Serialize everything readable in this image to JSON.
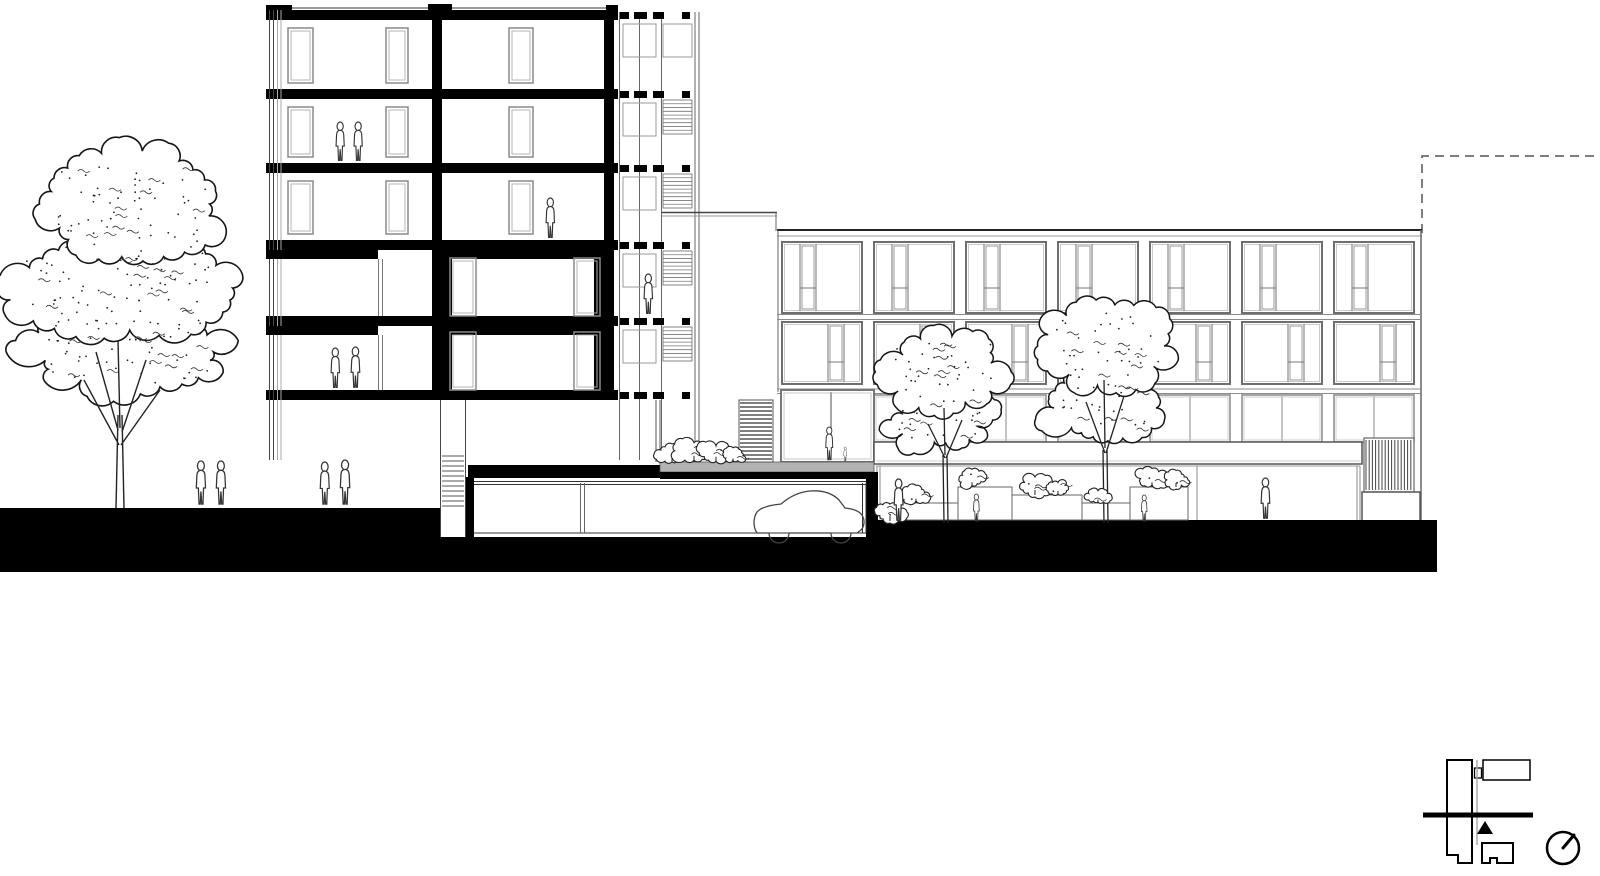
{
  "scene": {
    "kind": "architectural-section-elevation-drawing",
    "width": 1600,
    "height": 876,
    "background": "#ffffff",
    "description": "Black-and-white building cross-section / street elevation: five-storey sectioned tower with stair annex at left, four-storey apartment block elevation at right, underground parking garage with car, courtyard with trees, planters and human figures, large tree at far left, site key plan with section line and north arrow at bottom right"
  },
  "palette": {
    "ink": "#111111",
    "wall_black": "#000000",
    "line_dark": "#333333",
    "line_mid": "#777777",
    "line_light": "#b5b5b5",
    "terrace_gray": "#b3b3b3",
    "paper": "#ffffff"
  },
  "tower": {
    "x": 266,
    "right": 618,
    "storeys": 5,
    "slab_ys": [
      10,
      89,
      163,
      240,
      316,
      390
    ],
    "slab_h": 10,
    "roof_line_y": 8,
    "roof_upstands": [
      [
        266,
        5,
        26,
        5
      ],
      [
        428,
        4,
        24,
        6
      ],
      [
        606,
        5,
        12,
        5
      ]
    ],
    "center_wall_x": 432,
    "right_wall_x": 604,
    "wall_w": 10,
    "left_rail_xs": [
      269.5,
      273.5,
      277.5,
      281
    ],
    "heavy_floors": [
      3,
      4
    ],
    "heavy_lintel_left_w": 112,
    "heavy_window_xs": [
      378.5,
      382.5
    ],
    "doors_upper_left": [
      [
        288,
        25
      ],
      [
        386,
        22
      ]
    ],
    "door_upper_right": [
      509,
      24
    ],
    "doors_heavy_right": [
      [
        450,
        26
      ],
      [
        574,
        26
      ]
    ]
  },
  "annex": {
    "x": 618,
    "right": 700,
    "col_xs": [
      619.5,
      639.5,
      661.5,
      695,
      699
    ],
    "col_y1": 12,
    "col_y2": 460,
    "dash_segs": [
      [
        620,
        9
      ],
      [
        634,
        13
      ],
      [
        653,
        11
      ],
      [
        682,
        8
      ]
    ],
    "dash_h": 7,
    "rail": {
      "x": 623,
      "w": 33,
      "h": 33
    },
    "hatch": {
      "x": 663,
      "w": 29,
      "h": 34,
      "lines": 8
    },
    "low_wing": {
      "x1": 662,
      "x2": 777,
      "y1": 212.5,
      "y2": 216,
      "drop_x": 776,
      "drop_y": 231
    }
  },
  "right_building": {
    "x": 777,
    "right": 1422,
    "parapet_y": 230,
    "parapet_y2": 236,
    "band_lines": [
      314.5,
      319.5,
      389,
      393.5
    ],
    "bays": 7,
    "bay_start": 782,
    "bay_pitch": 92,
    "bay_w": 80,
    "rowA": {
      "y": 242,
      "h": 71,
      "door_off": 18,
      "door_w": 16,
      "rail_dy": 46
    },
    "rowB": {
      "y": 322,
      "h": 62,
      "door_off": 46,
      "door_w": 16,
      "rail_dy": 40
    },
    "glass_band": {
      "y": 395,
      "h": 47,
      "first_bay": 1
    },
    "tall_bay": {
      "x": 781,
      "y": 390,
      "w": 93,
      "h": 72,
      "mullion_x": 831
    },
    "canopy": {
      "x": 874,
      "y": 442,
      "w": 488,
      "h": 22
    },
    "storefront_cols": [
      877,
      880,
      1197,
      1357,
      1360
    ],
    "storefront_y1": 466,
    "storefront_y2": 520,
    "louver": {
      "x": 1364,
      "y": 438,
      "w": 50,
      "h": 54,
      "step": 3.2
    },
    "louver_base": {
      "x": 1362,
      "y": 492,
      "w": 58,
      "h": 31
    }
  },
  "terrace": {
    "black_slab": [
      468,
      465,
      194,
      13
    ],
    "gray": [
      660,
      462,
      214,
      10
    ],
    "black_under": [
      660,
      472,
      217,
      7
    ],
    "vent": {
      "x": 739,
      "y": 400,
      "w": 34,
      "h": 62,
      "step": 4
    },
    "wall_xs": [
      656,
      660
    ],
    "wall_y1": 400,
    "wall_y2": 462
  },
  "garage": {
    "cavity": [
      474,
      480,
      392,
      53
    ],
    "ceil_ys": [
      481.5,
      484.5
    ],
    "floor_y": 533,
    "right_wall_xs": [
      862.5,
      866
    ],
    "column_xs": [
      580.5,
      584.5
    ],
    "shaft_x1": 440.5,
    "shaft_x2": 465.5,
    "shaft_top": 400,
    "shaft_bottom": 537,
    "rungs": {
      "y1": 456,
      "y2": 506,
      "step": 5
    }
  },
  "ground": {
    "color": "#000000",
    "rects": [
      [
        0,
        508,
        440,
        64
      ],
      [
        440,
        537,
        438,
        35
      ],
      [
        466,
        477,
        8,
        60
      ],
      [
        866,
        472,
        12,
        71
      ],
      [
        878,
        520,
        559,
        52
      ]
    ]
  },
  "boundary": {
    "path": "M1422,233 L1422,156 L1600,156",
    "dash": "9 6"
  },
  "planters": [
    [
      900,
      503,
      58,
      17
    ],
    [
      958,
      487,
      54,
      33
    ],
    [
      1012,
      495,
      70,
      25
    ],
    [
      1082,
      503,
      48,
      17
    ],
    [
      1130,
      487,
      58,
      33
    ]
  ],
  "figures": [
    [
      194,
      461,
      46
    ],
    [
      214,
      461,
      46
    ],
    [
      318,
      462,
      45
    ],
    [
      338,
      460,
      47
    ],
    [
      334,
      122,
      41
    ],
    [
      352,
      122,
      41
    ],
    [
      544,
      198,
      42
    ],
    [
      642,
      274,
      42
    ],
    [
      329,
      348,
      42
    ],
    [
      349,
      347,
      43
    ],
    [
      824,
      427,
      35
    ],
    [
      843,
      447,
      15
    ],
    [
      892,
      479,
      44
    ],
    [
      972,
      494,
      29
    ],
    [
      1140,
      495,
      28
    ],
    [
      1259,
      478,
      43
    ]
  ],
  "shrubs": [
    [
      672,
      462,
      0.9,
      21
    ],
    [
      694,
      462,
      1.25,
      22
    ],
    [
      716,
      462,
      1.05,
      23
    ],
    [
      733,
      462,
      0.7,
      24
    ],
    [
      890,
      521,
      1.0,
      25
    ],
    [
      916,
      503,
      0.85,
      26
    ],
    [
      972,
      487,
      0.95,
      27
    ],
    [
      1035,
      495,
      1.0,
      28
    ],
    [
      1058,
      495,
      0.8,
      29
    ],
    [
      1098,
      503,
      0.7,
      30
    ],
    [
      1152,
      487,
      0.95,
      31
    ],
    [
      1176,
      487,
      0.8,
      32
    ]
  ],
  "trees": {
    "large": {
      "lobes": [
        [
          128,
          352,
          102,
          42,
          0.2,
          23
        ],
        [
          118,
          288,
          114,
          50,
          0.18,
          11
        ],
        [
          132,
          204,
          92,
          58,
          0.16,
          7
        ]
      ],
      "trunk": "M116,508 L118,415 M124,508 L122,415 M118,430 L96,352 M122,432 L146,360 M120,428 L118,340 M119,445 L84,380 M121,445 L160,390"
    },
    "court_a": {
      "lobes": [
        [
          940,
          420,
          52,
          30,
          0.25,
          6
        ],
        [
          944,
          372,
          62,
          40,
          0.22,
          5
        ]
      ],
      "trunk": "M944,523 L943,455 M948,523 L947,455 M945,458 L928,424 M946,458 L962,420 M945,455 L944,408"
    },
    "court_b": {
      "lobes": [
        [
          1100,
          408,
          56,
          34,
          0.24,
          10
        ],
        [
          1106,
          346,
          66,
          44,
          0.2,
          9
        ]
      ],
      "trunk": "M1104,523 L1103,450 M1108,523 L1107,450 M1105,453 L1086,402 M1106,453 L1124,396 M1105,448 L1104,380"
    }
  },
  "key_plan": {
    "tall_block": "M1447,760 L1472,760 L1472,863 L1458,863 L1458,855 L1447,855 Z",
    "top_right_block": [
      1483,
      760,
      47,
      20
    ],
    "tiny_block": [
      1474.5,
      768,
      7,
      10
    ],
    "connector_line": [
      1477,
      760,
      1477,
      845
    ],
    "bottom_block": "M1482,843 L1513,843 L1513,863 L1497,863 L1497,858 L1490,858 L1490,863 L1482,863 Z",
    "section_line": [
      1423,
      812.5,
      110,
      5
    ],
    "view_triangle": "M1485,821 L1477,834 L1493,834 Z",
    "north_circle": {
      "cx": 1563,
      "cy": 848,
      "r": 16
    },
    "north_hand": [
      1563,
      848,
      1574,
      835
    ]
  }
}
